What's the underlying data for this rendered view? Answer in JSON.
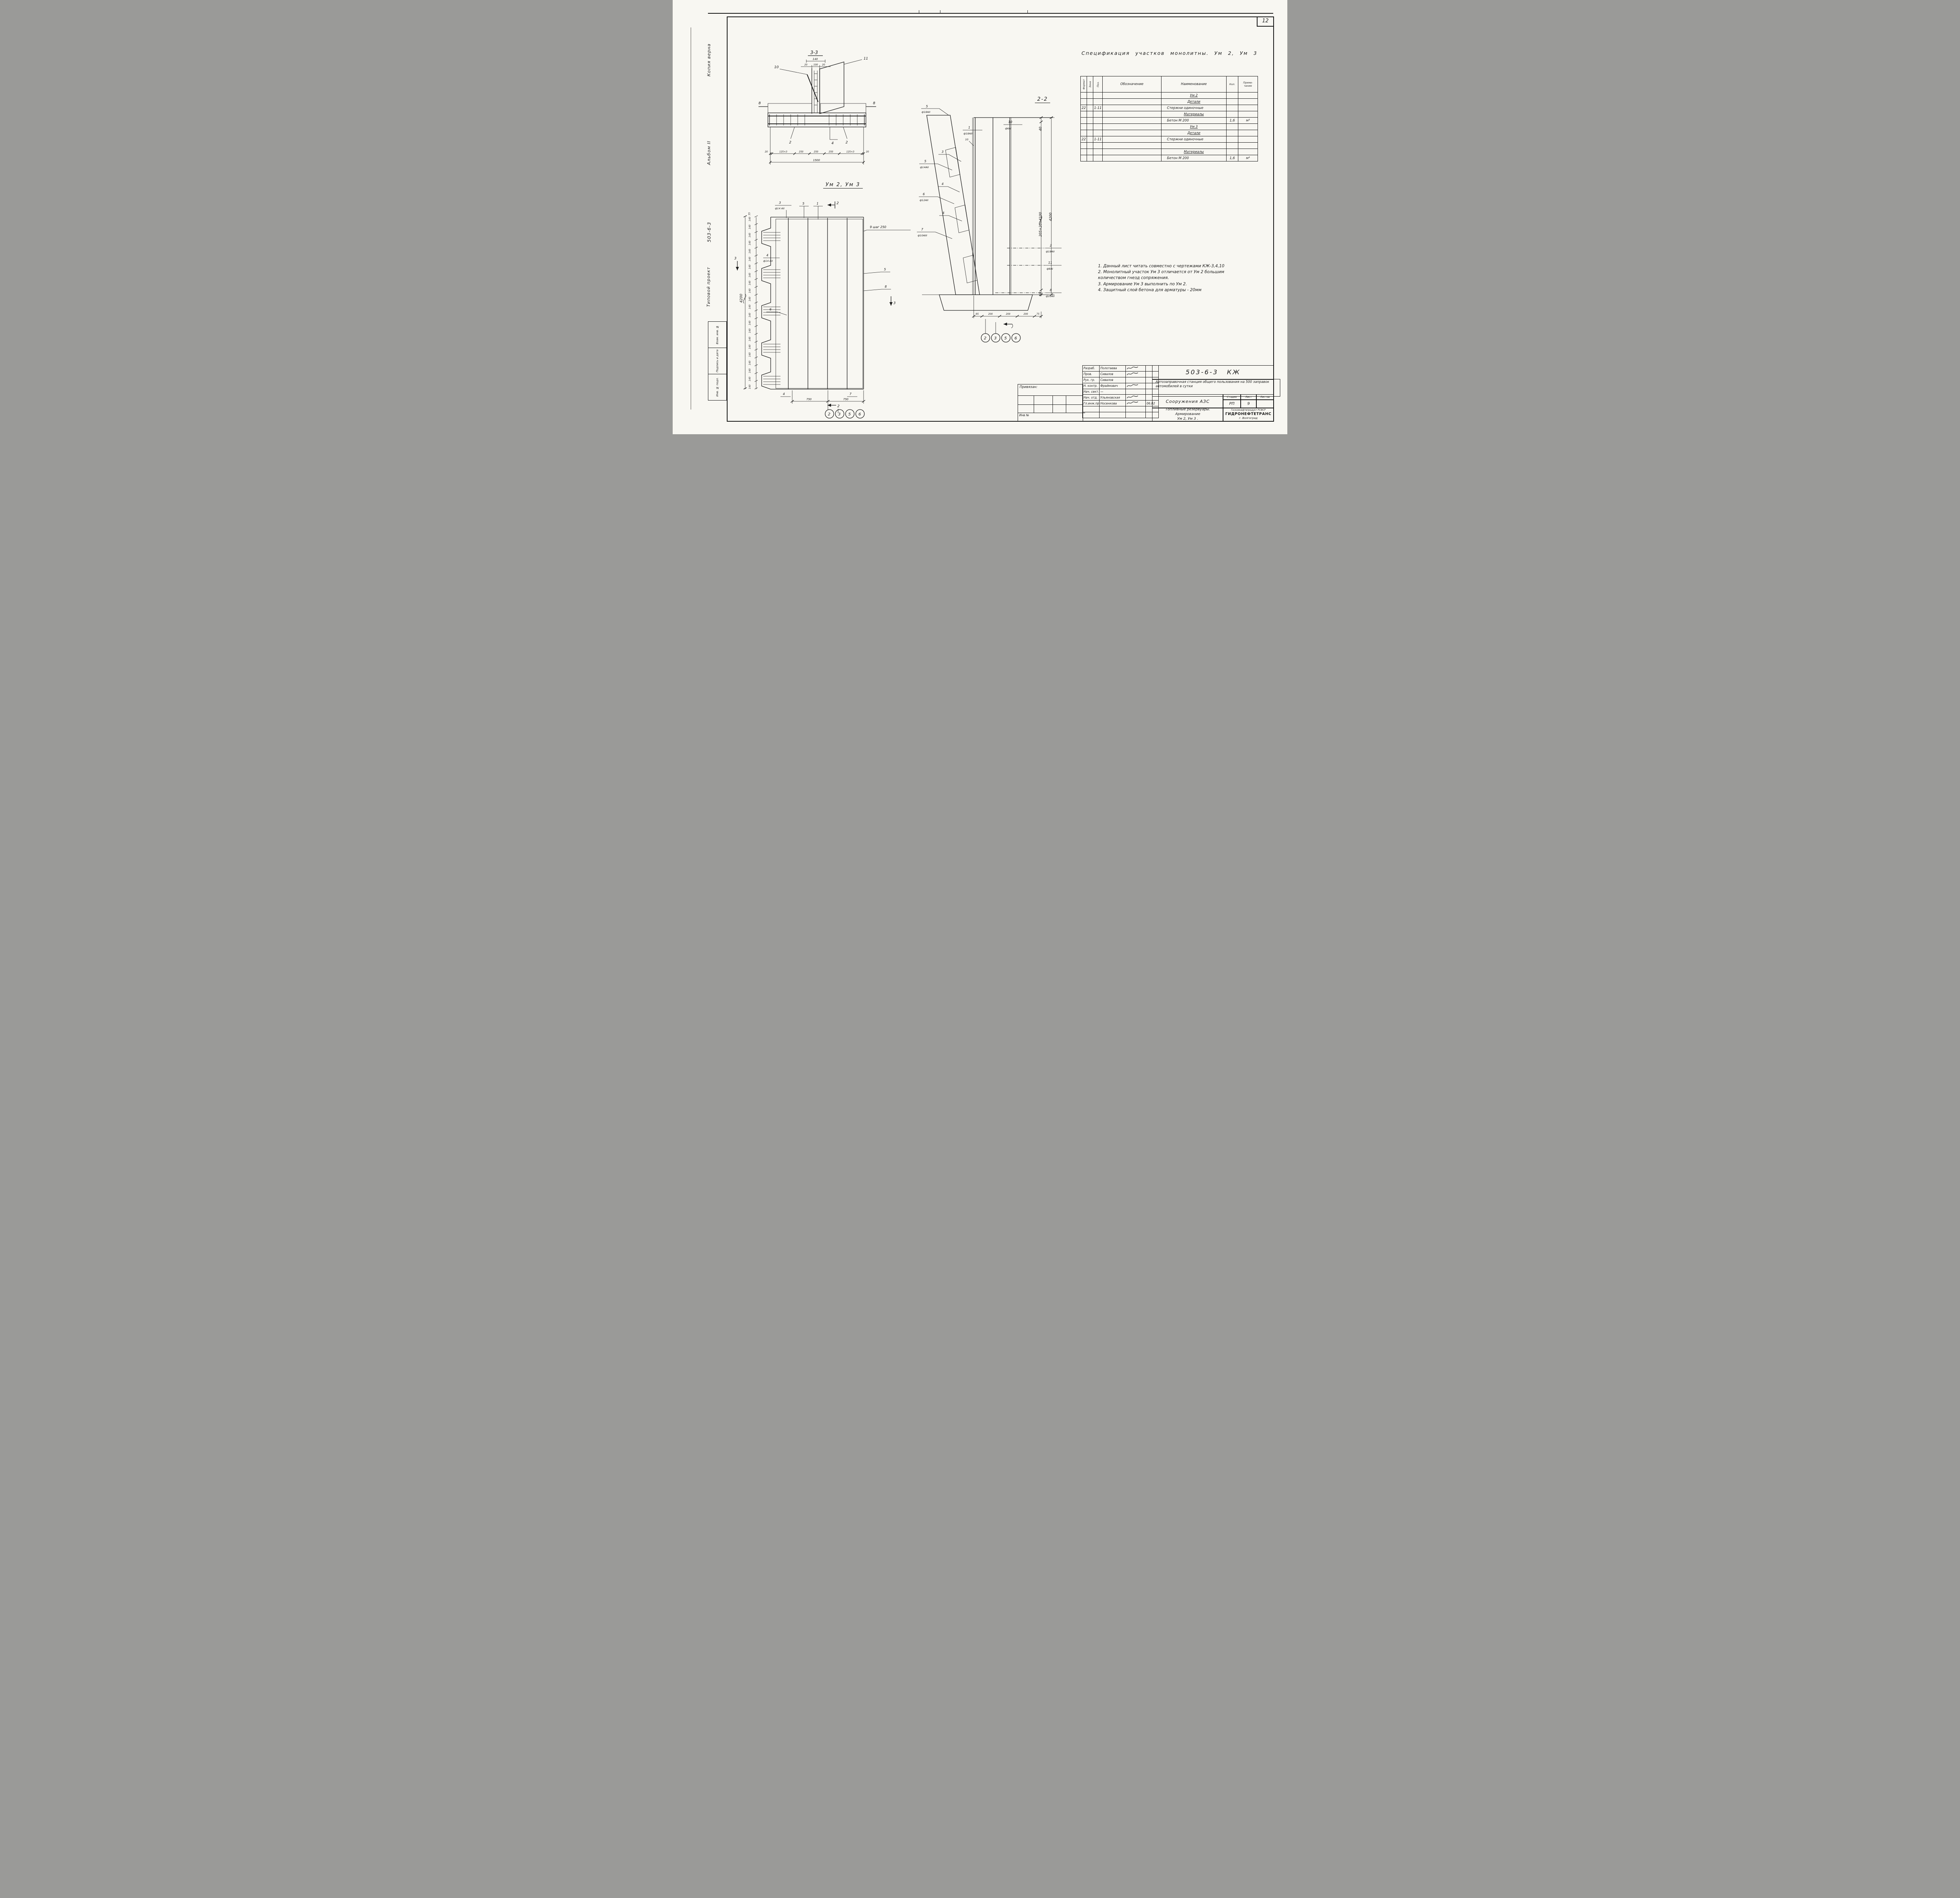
{
  "page": {
    "corner_number": "12"
  },
  "margin": {
    "copy_note": "Копия верна",
    "album": "Альбом II",
    "doc_number": "503-6-3",
    "project_type": "Типовой проект",
    "stamp_cells": [
      "Взам. инв. №",
      "Подпись и дата",
      "Инв. № подл."
    ]
  },
  "section33": {
    "title": "3-3",
    "dim_total_top": "140",
    "dims_top": [
      "20",
      "100",
      "20"
    ],
    "marks": {
      "m10": "10",
      "m11": "11",
      "m8_left": "8",
      "m8_right": "8",
      "m2_left": "2",
      "m4": "4",
      "m2_right": "2"
    },
    "dim_chain": [
      "20",
      "125×3",
      "250",
      "250",
      "250",
      "125×3",
      "20"
    ],
    "dim_total": "1500"
  },
  "plan": {
    "title": "Ум 2, Ум 3",
    "top_tick": "35",
    "left_ticks": [
      "140",
      "140",
      "140",
      "140",
      "140",
      "140",
      "140",
      "140",
      "140",
      "140",
      "140",
      "140",
      "140",
      "140",
      "140",
      "140",
      "140",
      "140",
      "140",
      "140",
      "140",
      "140"
    ],
    "left_total": "4200",
    "labels": {
      "top3_num": "3",
      "top3_spec": "ф14 АII",
      "top5": "5",
      "top1": "1",
      "sec2_top": "2",
      "sec2_bottom": "2",
      "sec3_left": "3",
      "sec3_right": "3",
      "right9": "9 шаг 250",
      "right5": "5",
      "right8": "8",
      "left4_num": "4",
      "left4_spec": "ф14 АII",
      "left6": "6",
      "bottom4": "4",
      "bottom7": "7"
    },
    "bottom_dims": [
      "750",
      "750"
    ],
    "callouts": [
      "2",
      "3",
      "5",
      "6"
    ]
  },
  "section22": {
    "title": "2-2",
    "left_labels": {
      "n5a": "5",
      "s5a": "ф18АII",
      "n1": "1",
      "s1": "ф18АIII",
      "n10b": "10",
      "n10": "10",
      "s10": "ф6АI",
      "n3": "3",
      "n5b": "5",
      "s5b": "ф14АII",
      "n4a": "4",
      "n6": "6",
      "s6": "ф12АII",
      "n4b": "4",
      "n7": "7",
      "s7": "ф10АIII"
    },
    "right_labels": {
      "n2": "2",
      "s2": "ф18АII",
      "n11": "11",
      "s11": "ф8АI",
      "n8": "8",
      "s8": "ф10АII"
    },
    "dims": {
      "top": "40",
      "chain": "205×20=4100",
      "total": "4200",
      "bottom": "60"
    },
    "bottom_dims": [
      "95",
      "200",
      "200",
      "200",
      "75"
    ],
    "callouts": [
      "2",
      "3",
      "5",
      "6"
    ]
  },
  "spec": {
    "title": "Спецификация участков монолитны. Ум 2, Ум 3",
    "cols": [
      "Формат",
      "Зона",
      "Поз.",
      "Обозначение",
      "Наименование",
      "Кол.",
      "Приме- чание"
    ],
    "rows": [
      {
        "f": "",
        "z": "",
        "p": "",
        "o": "",
        "n": "Ум 2",
        "k": "",
        "pr": "",
        "style": "hdr"
      },
      {
        "f": "",
        "z": "",
        "p": "",
        "o": "",
        "n": "Детали",
        "k": "",
        "pr": "",
        "style": "hdr"
      },
      {
        "f": "22",
        "z": "",
        "p": "1-11",
        "o": "",
        "n": "Стержни одиночные",
        "k": "",
        "pr": "",
        "style": "itm"
      },
      {
        "f": "",
        "z": "",
        "p": "",
        "o": "",
        "n": "Материалы",
        "k": "",
        "pr": "",
        "style": "hdr"
      },
      {
        "f": "",
        "z": "",
        "p": "",
        "o": "",
        "n": "Бетон  М 200",
        "k": "1,6",
        "pr": "м³",
        "style": "itm"
      },
      {
        "f": "",
        "z": "",
        "p": "",
        "o": "",
        "n": "Ум 3",
        "k": "",
        "pr": "",
        "style": "hdr"
      },
      {
        "f": "",
        "z": "",
        "p": "",
        "o": "",
        "n": "Детали",
        "k": "",
        "pr": "",
        "style": "hdr"
      },
      {
        "f": "22",
        "z": "",
        "p": "1-11",
        "o": "",
        "n": "Стержни одиночные",
        "k": "",
        "pr": "",
        "style": "itm"
      },
      {
        "f": "",
        "z": "",
        "p": "",
        "o": "",
        "n": "",
        "k": "",
        "pr": "",
        "style": "itm"
      },
      {
        "f": "",
        "z": "",
        "p": "",
        "o": "",
        "n": "Материалы",
        "k": "",
        "pr": "",
        "style": "hdr"
      },
      {
        "f": "",
        "z": "",
        "p": "",
        "o": "",
        "n": "Бетон  М 200",
        "k": "1,6",
        "pr": "м³",
        "style": "itm"
      }
    ]
  },
  "notes": {
    "items": [
      "1. Данный лист читать совместно с чертежами КЖ-3,4,10",
      "2. Монолитный участок Ум 3 отличается от Ум 2 большим количеством гнезд сопряжения.",
      "3. Армирование Ум 3 выполнить по Ум 2.",
      "4. Защитный слой бетона для арматуры - 20мм"
    ]
  },
  "titleblock": {
    "doc_number": "503-6-3 КЖ",
    "project": "Автозаправочная станция общего пользования на 500 заправок автомобилей в сутки",
    "object": "Сооружения АЗС",
    "stage_label": "Стадия",
    "sheet_label": "Лист",
    "sheets_label": "Листов",
    "stage": "РП",
    "sheet": "9",
    "sheets": "",
    "subject1": "Топливные резервуары.",
    "subject2": "Армирование",
    "subject3": "Ум 2,  Ум 3 .",
    "org_head": "Госкомнефтепродукт РСФСР",
    "org": "ГИДРОНЕФТЕТРАНС",
    "org_city": "г. Волгоград",
    "attached_label": "Привязан:",
    "inv_label": "Инв №",
    "sign_rows": [
      {
        "role": "Разраб.",
        "name": "Полотаева",
        "sig": "sig",
        "date": ""
      },
      {
        "role": "Пров.",
        "name": "Сивалов",
        "sig": "sig",
        "date": ""
      },
      {
        "role": "Рук. гр.",
        "name": "Сивалов",
        "sig": "",
        "date": ""
      },
      {
        "role": "Н. контр.",
        "name": "Фраймович",
        "sig": "sig",
        "date": ""
      },
      {
        "role": "Нач. сект.",
        "name": "—",
        "sig": "",
        "date": ""
      },
      {
        "role": "Нач. отд.",
        "name": "Ульяновская",
        "sig": "sig",
        "date": ""
      },
      {
        "role": "Гл.инж.пр.",
        "name": "Носенкова",
        "sig": "sig",
        "date": "06.82"
      },
      {
        "role": "",
        "name": "",
        "sig": "",
        "date": ""
      },
      {
        "role": "",
        "name": "",
        "sig": "",
        "date": ""
      }
    ]
  }
}
